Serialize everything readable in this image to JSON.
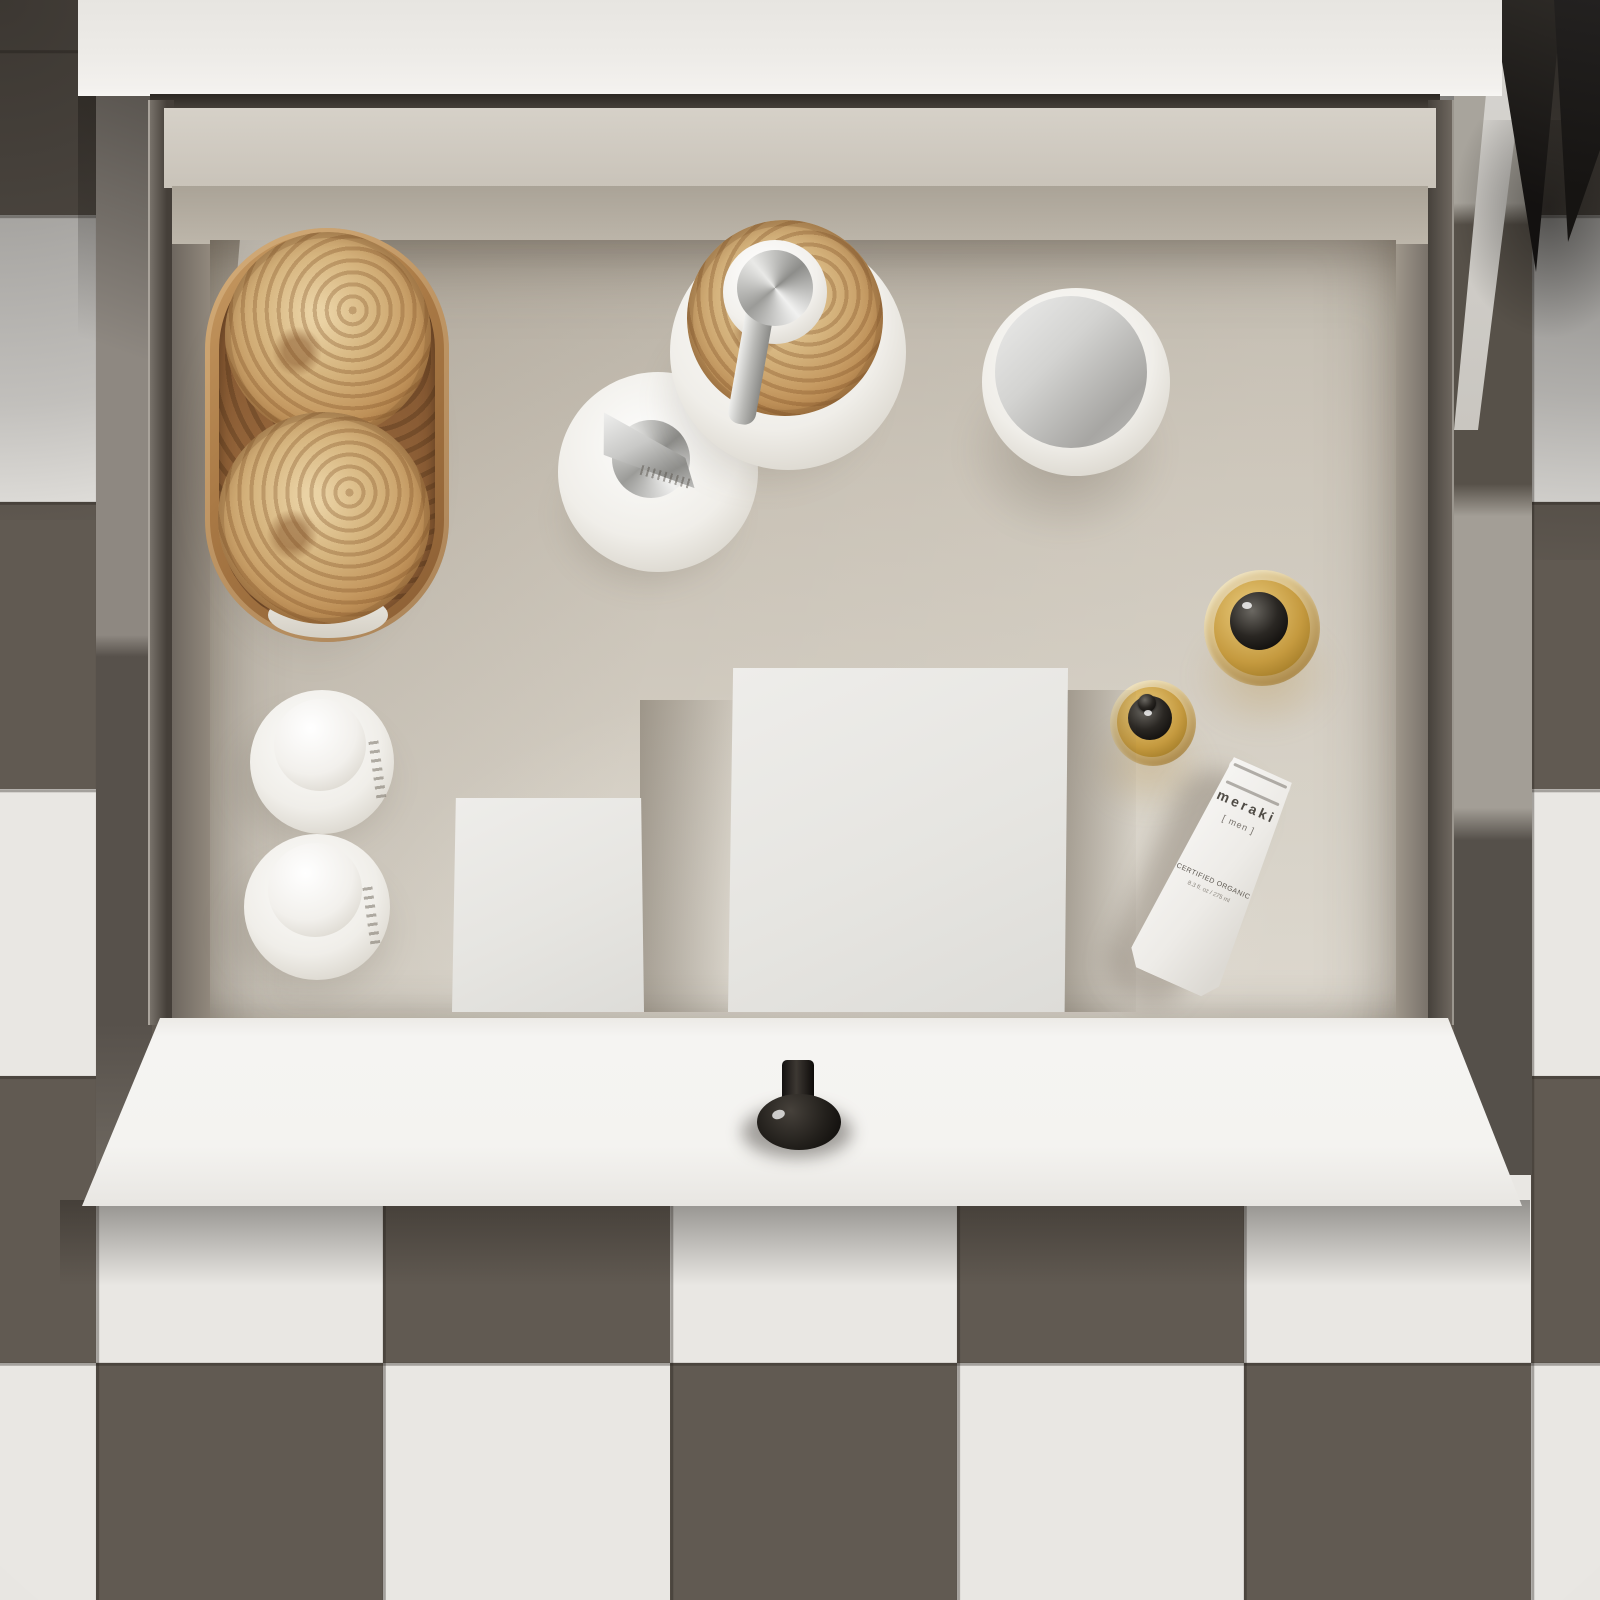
{
  "scene": {
    "description": "Top-down 3D render of an open white bathroom vanity drawer organized with toiletries, standing on a dark-and-white checkerboard tile floor",
    "objects": [
      "burl-wood-tray",
      "wood-lidded-jar",
      "wood-lidded-jar",
      "white-soap-dispenser-chrome-pump",
      "soap-dispenser-burl-wood-lid",
      "cream-jar-chrome-lid",
      "amber-dropper-bottle-large",
      "amber-dropper-bottle-small",
      "white-box-small",
      "white-box-large",
      "meraki-men-tube",
      "white-pump-bottle",
      "white-pump-bottle",
      "plant-leaves",
      "drawer-knob"
    ]
  },
  "palette": {
    "tileDark": "#615a52",
    "tileLight": "#e9e7e3",
    "grout": "rgba(35,30,25,0.35)",
    "countertop": "#edebe7",
    "gapDark": "#2c2823",
    "interior": "#cdc6ba",
    "wallDark": "#453f39",
    "wallLight": "#958c80",
    "backEdge": "#d6d1c8",
    "backFace": "#aaa397",
    "front": "#f4f3f0",
    "knobBlack": "#17140f",
    "woodLight": "#ead2a4",
    "woodMid": "#c09158",
    "woodDark": "#855832",
    "chromeLight": "#f1f1f0",
    "chromeDark": "#8d8d8a",
    "amber": "#c59a3f",
    "capBlack": "#0e0c0a",
    "boxWhite": "#e6e5e1",
    "bottleWhite": "#f0eee9",
    "leafDark": "#161412",
    "shadow": "rgba(70,60,48,0.35)"
  },
  "products": {
    "meraki_tube": {
      "brand": "meraki",
      "variant": "[ men ]",
      "certification": "CERTIFIED ORGANIC",
      "volume": "8.3 fl. oz / 275 ml"
    }
  }
}
